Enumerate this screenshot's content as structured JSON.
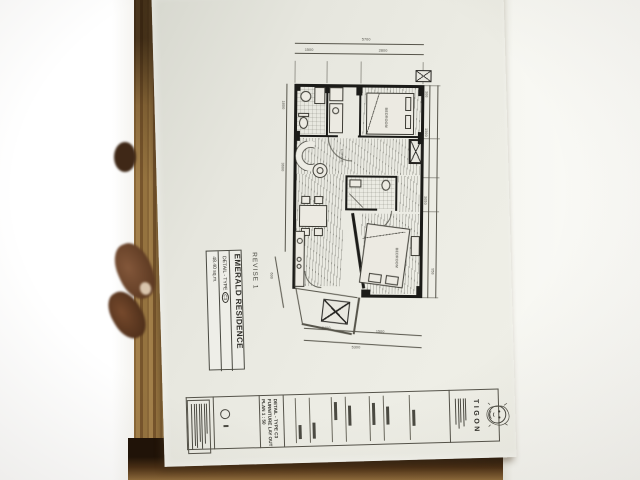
{
  "colors": {
    "paper": "#eaeae2",
    "ink": "#2e2d28",
    "wood_light": "#a3804a",
    "wood_dark": "#34200f",
    "skin": "#6b4228",
    "white_table": "#fdfdfb"
  },
  "sheet": {
    "revise": "REVISE 1",
    "project_box": {
      "title": "EMERALD RESIDENCE",
      "detail": "DETAIL - TYPE",
      "type_code": "C3",
      "area": "48.40 sq.m."
    },
    "plan": {
      "labels": {
        "bedroom1": "BEDROOM",
        "living": "LIVING",
        "bedroom2": "BEDROOM"
      },
      "dims": {
        "overall_top": "5700",
        "top_left": "1500",
        "top_right": "2800",
        "right_1": "300",
        "right_2": "1500",
        "right_3": "3050",
        "right_4": "950",
        "left_1": "1800",
        "left_2": "3600",
        "bottom_1": "2400",
        "bottom_2": "1500",
        "bottom_overall": "5300",
        "balcony": "600"
      }
    },
    "title_block": {
      "detail_line1": "DETAIL - TYPE C3",
      "detail_line2": "FURNITURE LAY OUT",
      "detail_line3": "PLAN  1 : 50",
      "brand": "TIGON"
    }
  }
}
